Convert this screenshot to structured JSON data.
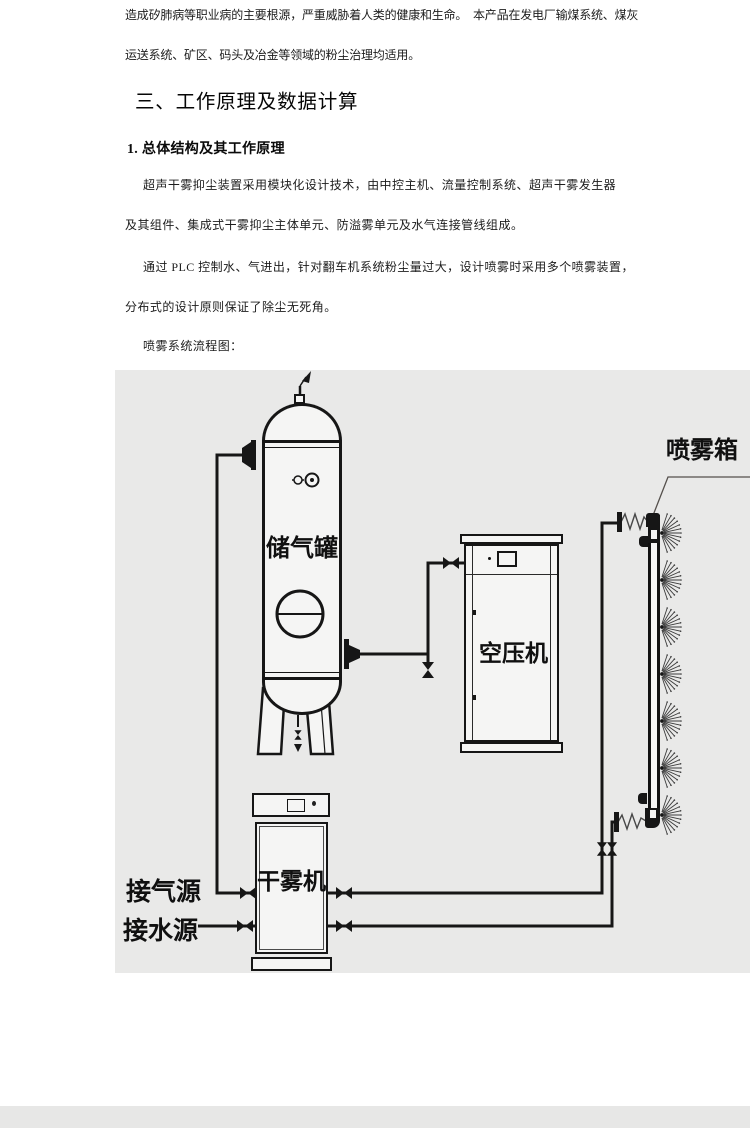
{
  "document": {
    "intro_lines": [
      "造成矽肺病等职业病的主要根源，严重威胁着人类的健康和生命。　本产品在发电厂输煤系统、煤灰",
      "运送系统、矿区、码头及冶金等领域的粉尘治理均适用。"
    ],
    "section_heading": "三、工作原理及数据计算",
    "subsection_heading": "1. 总体结构及其工作原理",
    "paragraph1_lines": [
      "超声干雾抑尘装置采用模块化设计技术，由中控主机、流量控制系统、超声干雾发生器",
      "及其组件、集成式干雾抑尘主体单元、防溢雾单元及水气连接管线组成。"
    ],
    "paragraph2_lines": [
      "通过 PLC 控制水、气进出，针对翻车机系统粉尘量过大，设计喷雾时采用多个喷雾装置，",
      "分布式的设计原则保证了除尘无死角。"
    ],
    "figure_caption": "喷雾系统流程图："
  },
  "diagram": {
    "labels": {
      "tank": "储气罐",
      "compressor": "空压机",
      "mist_machine": "干雾机",
      "spray_box": "喷雾箱",
      "gas_source": "接气源",
      "water_source": "接水源"
    },
    "colors": {
      "background": "#e9e9e8",
      "line_color": "#161616",
      "page_background": "#ffffff"
    }
  }
}
